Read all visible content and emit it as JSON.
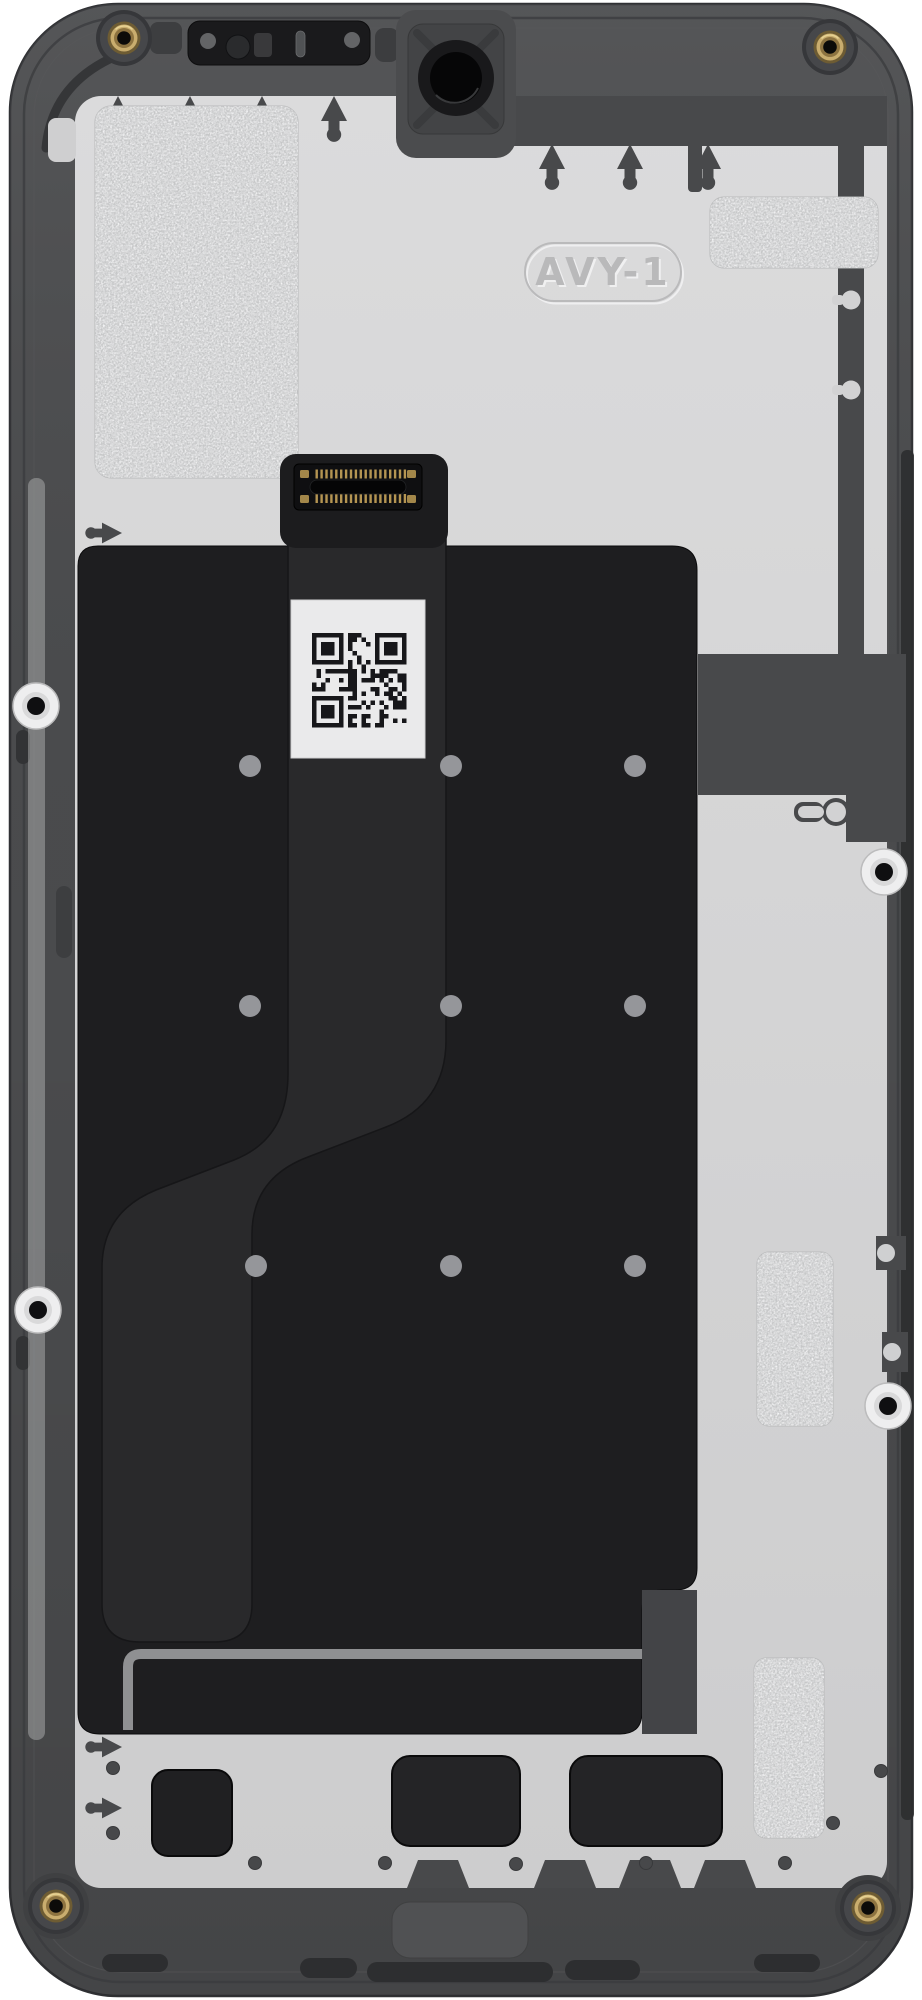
{
  "title": "Smartphone midframe display assembly, rear view product photo",
  "embossed_label": "AVY-1",
  "qr": {
    "seed": 12,
    "modules": 21
  },
  "colors": {
    "background": "#ffffff",
    "frame": "#4a4b4d",
    "backplate": "#d5d5d6",
    "panel": "#1e1e20",
    "flex": "#29292b",
    "sticker": "#eaeaeb",
    "screw_gold": "#c9ad6e",
    "bracket": "#8f9092",
    "qr_module": "#17171a"
  },
  "parts": [
    "outer midframe",
    "rear shield plate",
    "brass corner screw inserts (4)",
    "front camera opening",
    "earpiece speaker module",
    "sensor window",
    "adhesive foam patches (4)",
    "embossed mold mark",
    "QR code service sticker",
    "display flex cable",
    "board-to-board connector",
    "alignment bosses (4)",
    "interlocking antenna tabs",
    "bottom speaker cutouts",
    "metal bracket rail"
  ]
}
